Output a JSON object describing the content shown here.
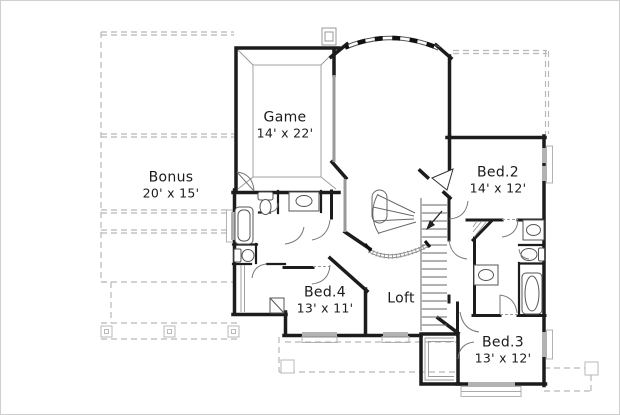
{
  "plan": {
    "type": "second-floor-plan",
    "rooms": {
      "bonus": {
        "name": "Bonus",
        "dims": "20' x 15'"
      },
      "game": {
        "name": "Game",
        "dims": "14' x 22'"
      },
      "bed2": {
        "name": "Bed.2",
        "dims": "14' x 12'"
      },
      "bed4": {
        "name": "Bed.4",
        "dims": "13' x 11'"
      },
      "loft": {
        "name": "Loft",
        "dims": ""
      },
      "bed3": {
        "name": "Bed.3",
        "dims": "13' x 12'"
      }
    },
    "colors": {
      "wall": "#1c1c1c",
      "window": "#b3b3b3",
      "roof_dash": "#b8b8b8",
      "fixture": "#555555",
      "background": "#ffffff",
      "text": "#1b1b1b"
    }
  }
}
